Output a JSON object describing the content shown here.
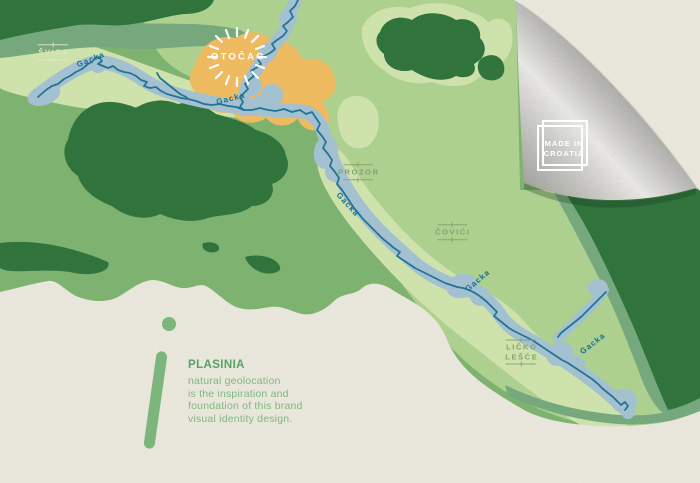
{
  "map": {
    "towns": {
      "svica": "ŠVICA",
      "otocac": "OTOČAC",
      "prozor": "PROZOR",
      "covici": "ČOVIĆI",
      "licko_lesce": [
        "LIČKO",
        "LEŠĆE"
      ]
    },
    "river_name": "Gacka"
  },
  "badge": {
    "line1": "MADE IN",
    "line2": "CROATIA"
  },
  "callout": {
    "title": "PLASINIA",
    "lines": [
      "natural geolocation",
      "is the inspiration and",
      "foundation of this brand",
      "visual identity design."
    ]
  },
  "colors": {
    "paper": "#eae7dc",
    "green_dark": "#2d7239",
    "green_medium": "#7cb26e",
    "green_sage": "#74a87b",
    "green_light": "#add18e",
    "green_pale": "#cfe3ac",
    "river_band": "#a3c1d1",
    "river_line": "#1f7294",
    "town_orange": "#f0ba5e",
    "label_cream": "#e6e5c0",
    "label_olive": "#84a171",
    "river_label_teal": "#1a6f8f",
    "brand_green": "#55a365",
    "brand_text_green": "#7fb780",
    "badge_white": "#ffffff",
    "foil_bright": "#f2f1ec",
    "foil_dark": "#90908d"
  }
}
